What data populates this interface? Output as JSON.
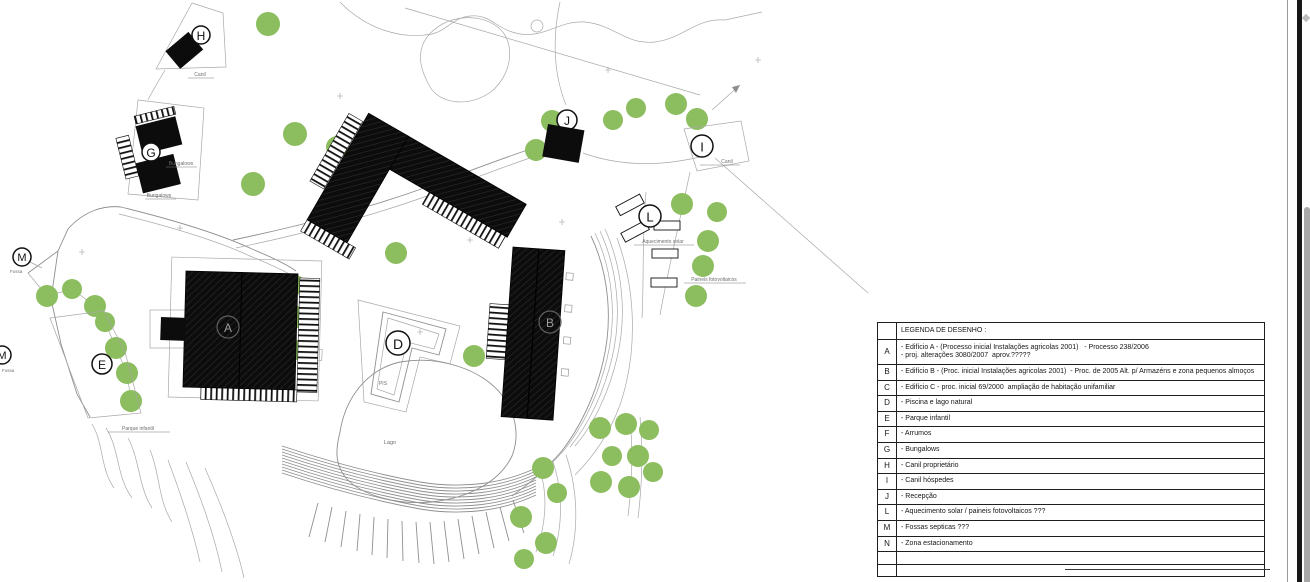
{
  "legend": {
    "header": "LEGENDA DE DESENHO :",
    "rows": [
      {
        "key": "A",
        "text": "- Edifício A - (Processo inicial Instalações agricolas 2001)   - Processo 238/2006",
        "text2": "- proj. alterações 3080/2007  aprov.?????"
      },
      {
        "key": "B",
        "text": "- Edifício B - (Proc. inicial Instalações agricolas 2001)  - Proc. de 2005 Alt. p/ Armazéns e zona pequenos almoços"
      },
      {
        "key": "C",
        "text": "- Edifício C - proc. inicial 69/2000  ampliação de habitação unifamiliar"
      },
      {
        "key": "D",
        "text": "- Piscina e lago natural"
      },
      {
        "key": "E",
        "text": "- Parque infantil"
      },
      {
        "key": "F",
        "text": "- Arrumos"
      },
      {
        "key": "G",
        "text": "- Bungalows"
      },
      {
        "key": "H",
        "text": "- Canil proprietário"
      },
      {
        "key": "I",
        "text": "- Canil hóspedes"
      },
      {
        "key": "J",
        "text": "- Recepção"
      },
      {
        "key": "L",
        "text": "- Aquecimento solar / paineis fotovoltaicos ???"
      },
      {
        "key": "M",
        "text": "- Fossas septicas ???"
      },
      {
        "key": "N",
        "text": "- Zona estacionamento"
      },
      {
        "key": "",
        "text": ""
      },
      {
        "key": "",
        "text": ""
      }
    ]
  },
  "plan": {
    "markers": [
      {
        "letter": "H"
      },
      {
        "letter": "G"
      },
      {
        "letter": "A"
      },
      {
        "letter": "B"
      },
      {
        "letter": "D"
      },
      {
        "letter": "E"
      },
      {
        "letter": "I"
      },
      {
        "letter": "J"
      },
      {
        "letter": "L"
      },
      {
        "letter": "M"
      },
      {
        "letter": "M"
      }
    ],
    "labels": {
      "canil_h": "Canil",
      "bungalows": "Bungalows",
      "pis": "PIS",
      "lago": "Lago",
      "aquecimento_solar": "Aquecimento solar",
      "paineis_fotovoltaicos": "Paineis fotovoltaicos",
      "canil_i": "Canil",
      "parque_infantil": "Parque infantil",
      "fossa": "Fossa"
    },
    "colors": {
      "tree": "#8cbd5e",
      "line": "#8a8a8a",
      "building": "#0d0d0d",
      "scroll_thumb": "#a8a8a8"
    }
  }
}
